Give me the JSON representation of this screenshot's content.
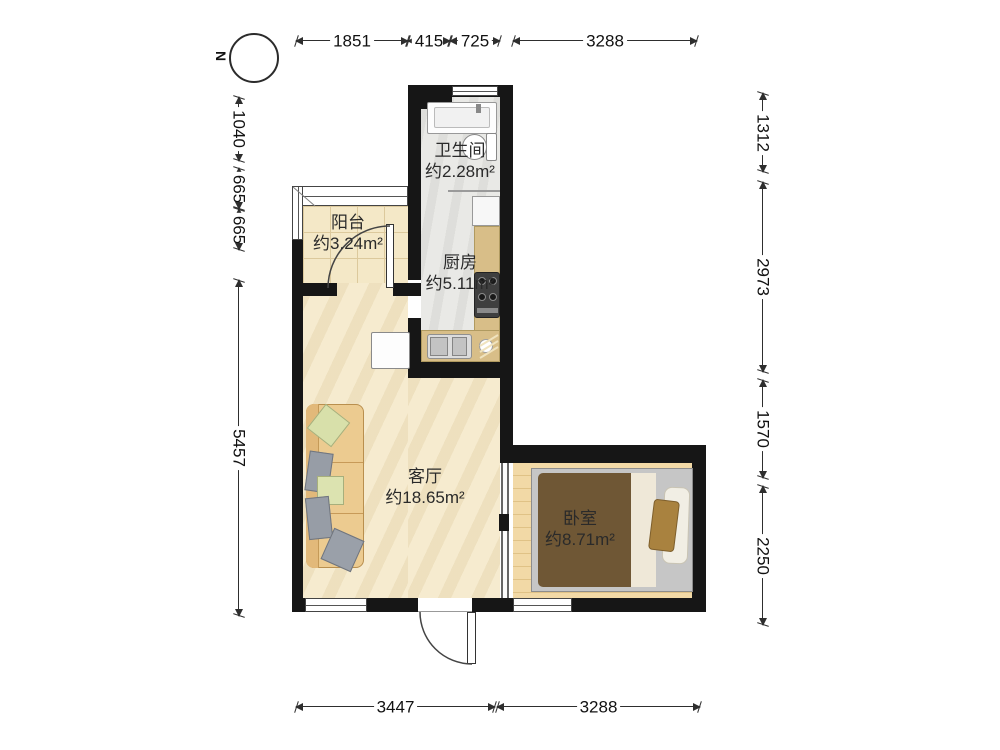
{
  "compass": {
    "label": "N"
  },
  "rooms": {
    "bathroom": {
      "name": "卫生间",
      "area": "约2.28m²"
    },
    "kitchen": {
      "name": "厨房",
      "area": "约5.11m²"
    },
    "balcony": {
      "name": "阳台",
      "area": "约3.24m²"
    },
    "living_room": {
      "name": "客厅",
      "area": "约18.65m²"
    },
    "bedroom": {
      "name": "卧室",
      "area": "约8.71m²"
    }
  },
  "dimensions": {
    "top": [
      "1851",
      "415",
      "725",
      "3288"
    ],
    "left": [
      "1040",
      "665",
      "665",
      "5457"
    ],
    "right": [
      "1312",
      "2973",
      "1570",
      "2250"
    ],
    "bottom": [
      "3447",
      "3288"
    ]
  },
  "colors": {
    "wall": "#161616",
    "living_floor": "#f6ebcf",
    "balcony_floor": "#f4e8c7",
    "tile_floor": "#e9e9e6",
    "counter": "#d8be88",
    "bedroom_floor": "#f2d9a6",
    "blanket": "#6f5735",
    "sofa": "#eccb90"
  }
}
